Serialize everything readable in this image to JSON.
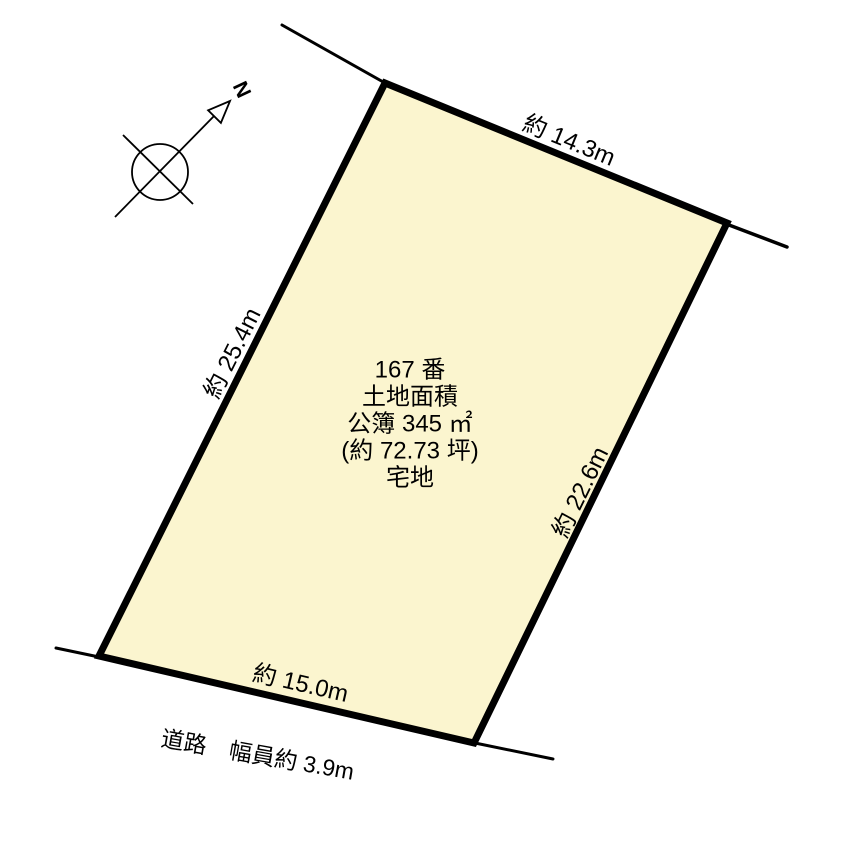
{
  "diagram": {
    "compass": {
      "north_label": "N"
    },
    "parcel": {
      "fill_color": "#FBF5CF",
      "line_color": "#000000",
      "center_lines": [
        "167 番",
        "土地面積",
        "公簿 345 ㎡",
        "(約 72.73 坪)",
        "宅地"
      ]
    },
    "dimensions": {
      "top": "約 14.3m",
      "left": "約 25.4m",
      "right": "約 22.6m",
      "bottom": "約 15.0m"
    },
    "road": {
      "label": "道路　幅員約 3.9m"
    }
  }
}
